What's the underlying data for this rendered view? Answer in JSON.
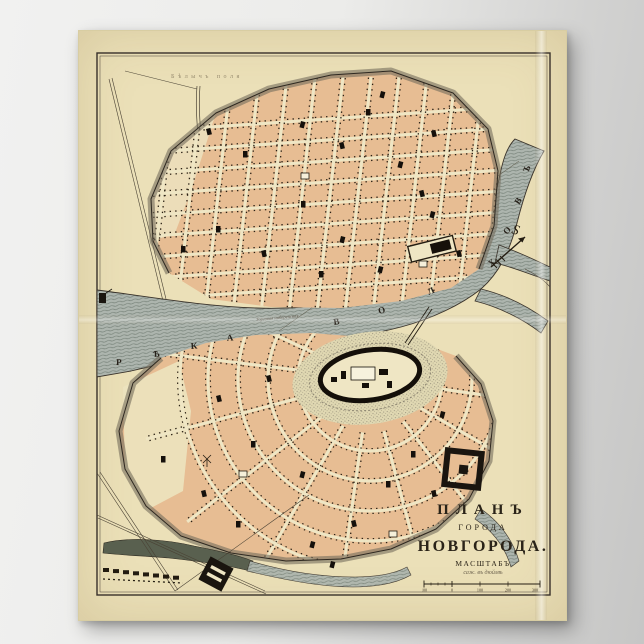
{
  "poster": {
    "title_line1": "ПЛАНЪ",
    "title_line2": "ГОРОДА",
    "title_line3": "НОВГОРОДА.",
    "scale_heading": "МАСШТАБЪ",
    "scale_note": "саж. въ дюймѣ",
    "scale_bar_labels": [
      "100",
      "0",
      "100",
      "200",
      "300"
    ]
  },
  "map_labels": {
    "field_label": "Бѣлычъ поля",
    "embankment_label": "Торговая набережная",
    "north_label": "S",
    "river_letters": [
      "Р",
      "Ѣ",
      "К",
      "А",
      "В",
      "О",
      "Л",
      "Х",
      "О",
      "В",
      "Ъ"
    ]
  },
  "colors": {
    "paper": "#ebe0b8",
    "city_ground": "#efe6c4",
    "blocks": "#e7bd93",
    "river": "#adb5ae",
    "ink": "#241d12"
  }
}
